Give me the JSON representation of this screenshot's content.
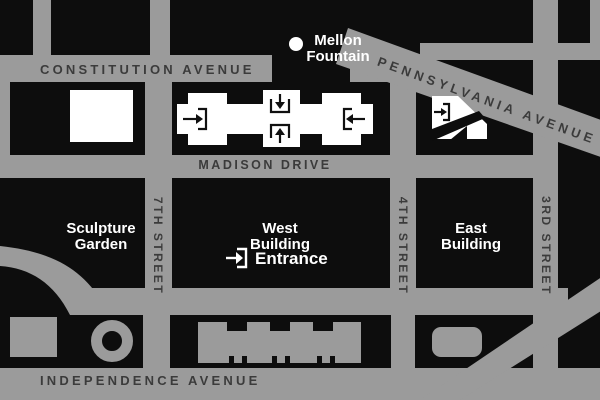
{
  "colors": {
    "street": "#9b9b9b",
    "block": "#0d0d0d",
    "building": "#ffffff",
    "street_label": "#3b3b3b",
    "place_label": "#ffffff"
  },
  "streets": {
    "constitution": "CONSTITUTION AVENUE",
    "pennsylvania": "PENNSYLVANIA AVENUE",
    "madison": "MADISON DRIVE",
    "independence": "INDEPENDENCE AVENUE",
    "seventh": "7TH STREET",
    "fourth": "4TH STREET",
    "third": "3RD STREET"
  },
  "places": {
    "mellon_line1": "Mellon",
    "mellon_line2": "Fountain",
    "sculpture_line1": "Sculpture",
    "sculpture_line2": "Garden",
    "west_line1": "West",
    "west_line2": "Building",
    "east_line1": "East",
    "east_line2": "Building"
  },
  "legend": {
    "entrance": "Entrance"
  },
  "icons": {
    "entrance": "entry-arrow-right-icon",
    "west_building_entries": [
      "entry-arrow-right-icon",
      "entry-arrow-down-icon",
      "entry-arrow-up-icon",
      "entry-arrow-left-icon"
    ],
    "east_building_entry": "entry-arrow-right-icon",
    "mellon_marker": "fountain-dot-marker"
  }
}
